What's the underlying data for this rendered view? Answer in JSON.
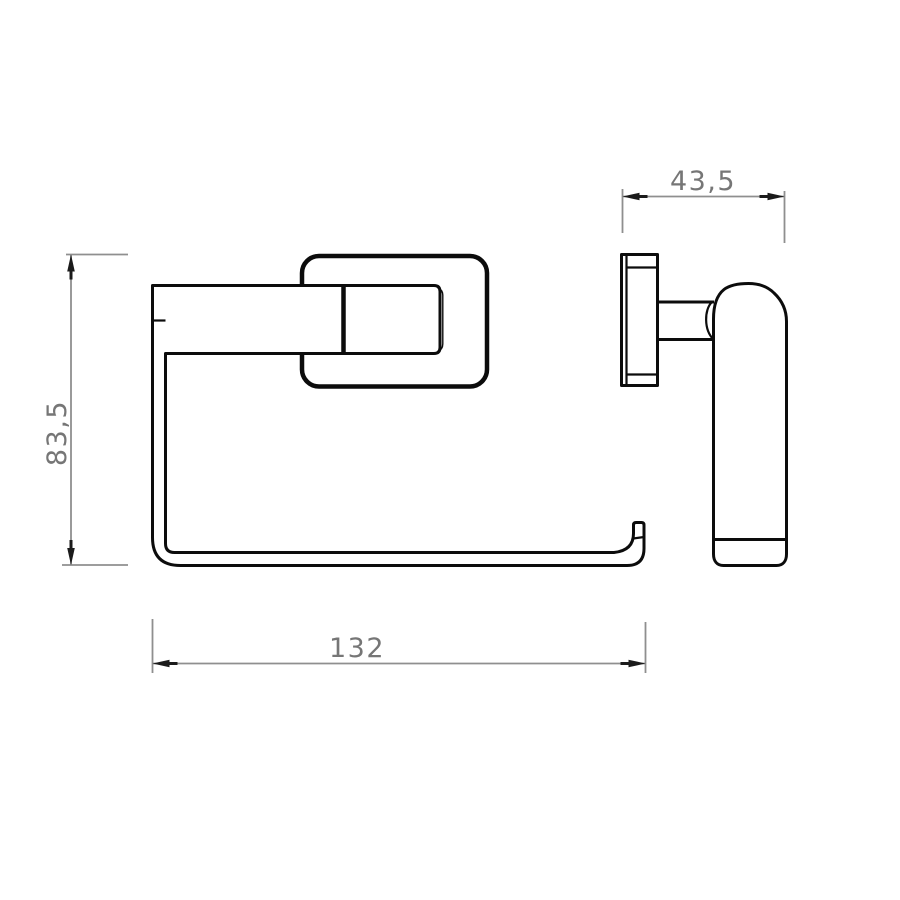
{
  "dimensions": {
    "depth": {
      "label": "43,5"
    },
    "height": {
      "label": "83,5"
    },
    "width": {
      "label": "132"
    }
  },
  "colors": {
    "background": "#ffffff",
    "object_line": "#0c0c0c",
    "dimension_line": "#8f8f8f",
    "dimension_text": "#767676",
    "arrow": "#1b1b1b"
  }
}
